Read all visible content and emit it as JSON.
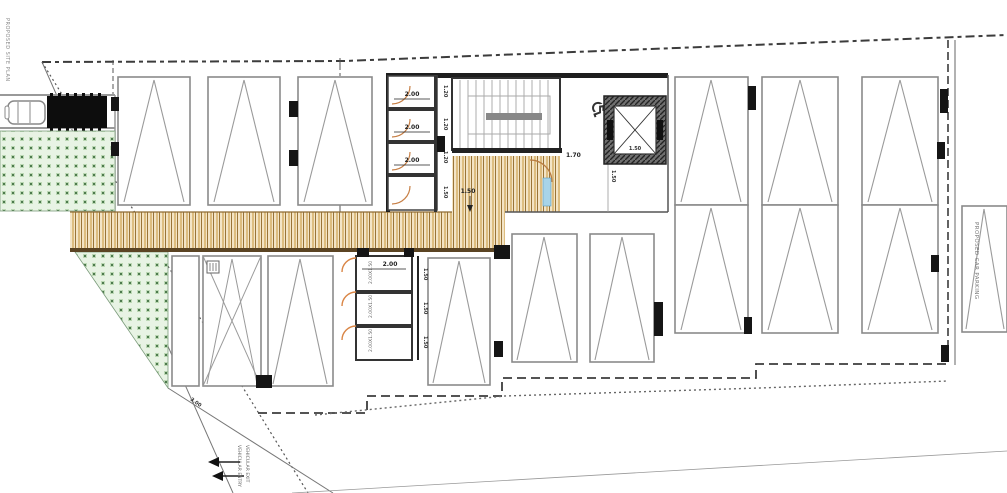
{
  "title": "Proposed car parking floor plan",
  "colors": {
    "walkway_fill": "#f3e4c6",
    "walkway_stripe": "#c8a05a",
    "walkway_edge": "#5b4423",
    "green_fill": "#e8f3e4",
    "green_dot": "#4e7a4e",
    "door_arc": "#c77f45",
    "wall_dark": "#1e1e1e",
    "stall_border": "#8a8a8a",
    "boundary_dash": "#444444",
    "water_feature": "#a8d4e8"
  },
  "icons": {
    "accessible": "♿"
  },
  "labels": {
    "margin_note": "PROPOSED SITE PLAN",
    "rooms_top": {
      "r1_width": "2.00",
      "r2_width": "2.00",
      "r3_width": "2.00",
      "r1_depth": "1.20",
      "r2_depth": "1.20",
      "r3_depth": "1.20",
      "lobby_depth": "1.50"
    },
    "stairs_clear": "1.70",
    "lift_cab": "1.50",
    "lift_shaft": "1.50",
    "walkway_width": "1.50",
    "rooms_bottom": {
      "width": "2.00",
      "r1_depth": "1.50",
      "r2_depth": "1.50",
      "r3_depth": "1.50",
      "r1_size": "2.00X1.50",
      "r2_size": "2.00X1.50",
      "r3_size": "2.00X1.50"
    },
    "ramp_dim": "3.00",
    "driveway_entry": "VEHICULAR ENTRY",
    "driveway_exit": "VEHICULAR EXIT",
    "visitor_stall": "PROPOSED CAR PARKING"
  }
}
